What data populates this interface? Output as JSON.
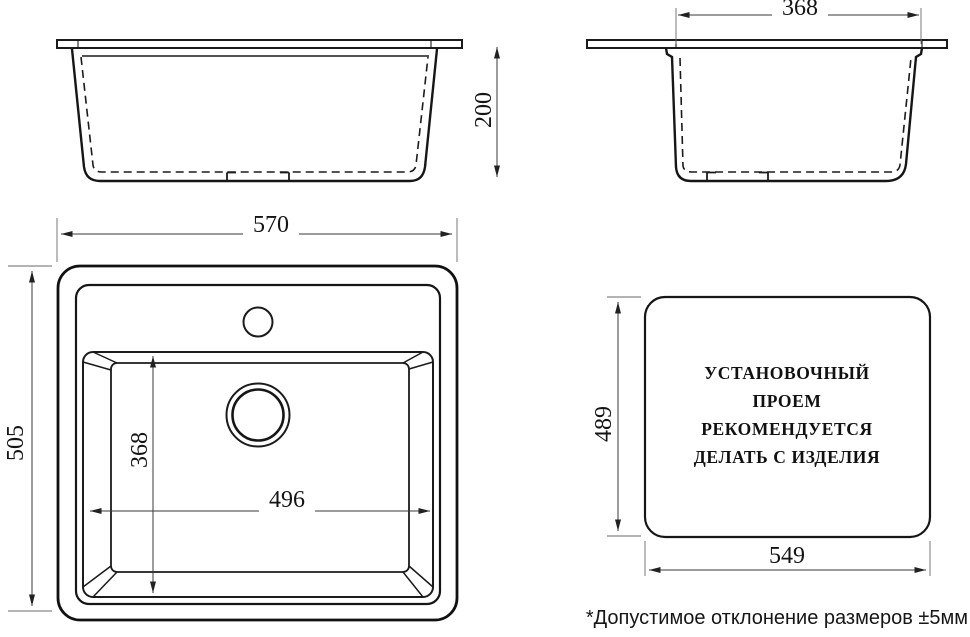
{
  "diagram": {
    "title": "sink-installation-dimensions-drawing",
    "colors": {
      "line": "#1b1b1b",
      "background": "#ffffff"
    },
    "views": {
      "front": {
        "height": "200"
      },
      "side": {
        "top_width": "368"
      },
      "top": {
        "width": "570",
        "depth": "505",
        "bowl_depth": "368",
        "bowl_width": "496"
      },
      "cutout": {
        "height": "489",
        "width": "549",
        "note_lines": [
          "УСТАНОВОЧНЫЙ",
          "ПРОЕМ",
          "РЕКОМЕНДУЕТСЯ",
          "ДЕЛАТЬ С ИЗДЕЛИЯ"
        ]
      }
    },
    "footnote": "*Допустимое отклонение размеров ±5мм"
  }
}
